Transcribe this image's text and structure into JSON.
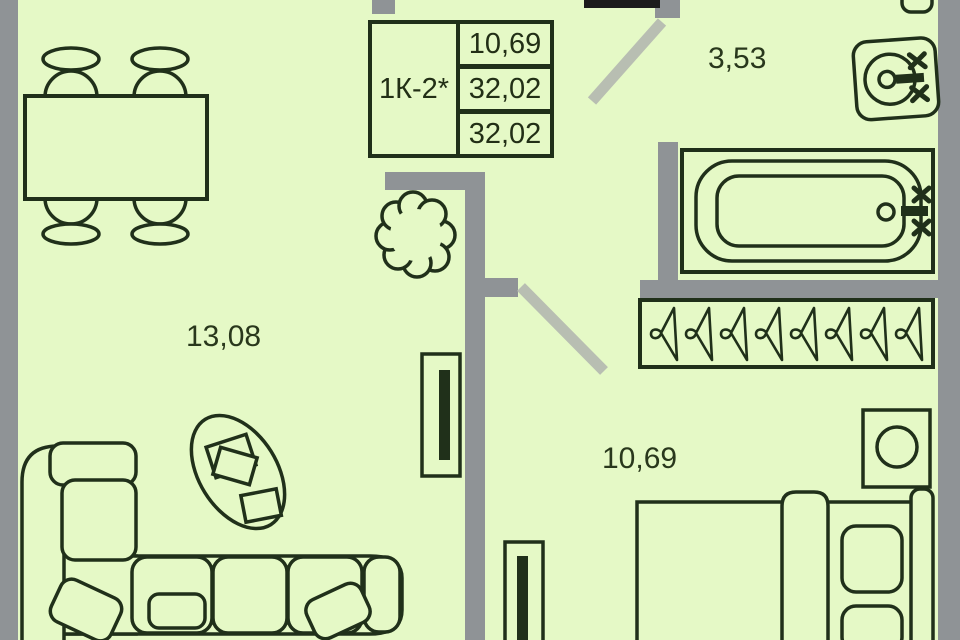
{
  "plan": {
    "unit_label": "1К-2*",
    "areas": {
      "row1": "10,69",
      "row2": "32,02",
      "row3": "32,02"
    },
    "rooms": {
      "bathroom": "3,53",
      "living_room": "13,08",
      "bedroom": "10,69"
    },
    "colors": {
      "background": "#e5f9c6",
      "wall": "#8f9396",
      "outline": "#20301a",
      "door_leaf": "#b8beb2",
      "entrance_bar": "#1b1b1b"
    }
  }
}
